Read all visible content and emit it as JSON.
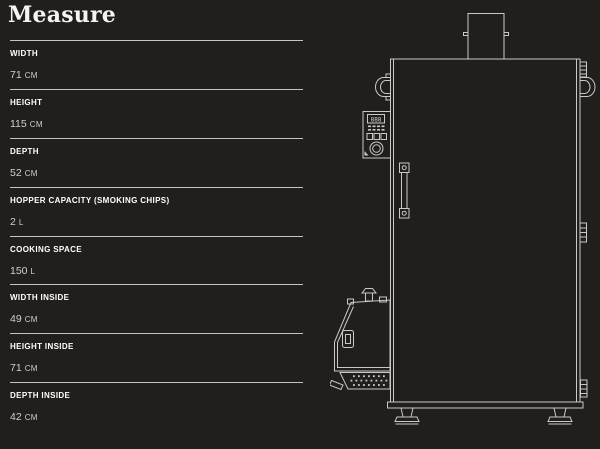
{
  "title": "Measure",
  "measurements": [
    {
      "label": "WIDTH",
      "value": "71",
      "unit": "CM"
    },
    {
      "label": "HEIGHT",
      "value": "115",
      "unit": "CM"
    },
    {
      "label": "DEPTH",
      "value": "52",
      "unit": "CM"
    },
    {
      "label": "HOPPER CAPACITY (SMOKING CHIPS)",
      "value": "2",
      "unit": "L"
    },
    {
      "label": "COOKING SPACE",
      "value": "150",
      "unit": "L"
    },
    {
      "label": "WIDTH INSIDE",
      "value": "49",
      "unit": "CM"
    },
    {
      "label": "HEIGHT INSIDE",
      "value": "71",
      "unit": "CM"
    },
    {
      "label": "DEPTH INSIDE",
      "value": "42",
      "unit": "CM"
    }
  ],
  "diagram": {
    "description": "line drawing of smoker cabinet with chimney, control panel, door handle and smoke generator hopper",
    "panel_display": "888"
  },
  "colors": {
    "background": "#211e1c",
    "text_primary": "#ffffff",
    "text_secondary": "#d2d0cd",
    "divider": "#c6c4c1",
    "line_art": "#c9c9c9"
  }
}
